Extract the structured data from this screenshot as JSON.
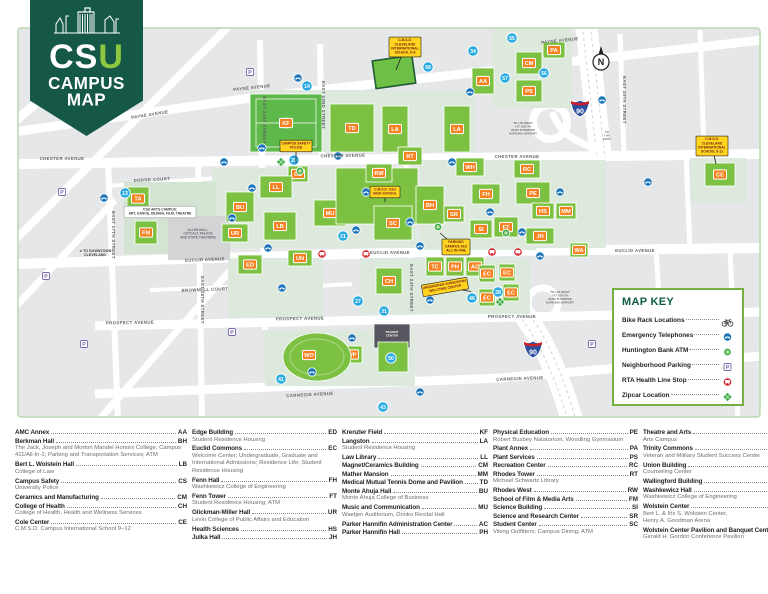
{
  "colors": {
    "pennant_green": "#155847",
    "csu_u_green": "#8dc63f",
    "building_green": "#7cc142",
    "field_green": "#5fb84a",
    "sage": "#dde9dc",
    "block_gray": "#e6e7e8",
    "badge_orange": "#f58220",
    "lot_blue": "#29abe2",
    "phone_blue": "#1a74ba",
    "rta_red": "#d6212b",
    "zip_green": "#3fae49",
    "callout_yellow": "#ffd520",
    "key_border": "#76b043",
    "frame_green": "#bcd9b0"
  },
  "logo": {
    "acronym_cs": "CS",
    "acronym_u": "U",
    "title_line1": "CAMPUS",
    "title_line2": "MAP"
  },
  "map": {
    "street_labels": [
      {
        "t": "PAYNE AVENUE",
        "x": 150,
        "y": 116,
        "r": -9
      },
      {
        "t": "PAYNE AVENUE",
        "x": 252,
        "y": 89,
        "r": -6
      },
      {
        "t": "PAYNE AVENUE",
        "x": 560,
        "y": 42,
        "r": -6
      },
      {
        "t": "CHESTER AVENUE",
        "x": 62,
        "y": 160,
        "r": 0
      },
      {
        "t": "CHESTER AVENUE",
        "x": 343,
        "y": 157,
        "r": -1
      },
      {
        "t": "CHESTER AVENUE",
        "x": 517,
        "y": 158,
        "r": 0
      },
      {
        "t": "EUCLID AVENUE",
        "x": 205,
        "y": 261,
        "r": -2
      },
      {
        "t": "EUCLID AVENUE",
        "x": 390,
        "y": 254,
        "r": 0
      },
      {
        "t": "EUCLID AVENUE",
        "x": 635,
        "y": 252,
        "r": 0
      },
      {
        "t": "PROSPECT AVENUE",
        "x": 130,
        "y": 324,
        "r": -1
      },
      {
        "t": "PROSPECT AVENUE",
        "x": 300,
        "y": 320,
        "r": -1
      },
      {
        "t": "PROSPECT AVENUE",
        "x": 512,
        "y": 318,
        "r": 0
      },
      {
        "t": "CARNEGIE AVENUE",
        "x": 310,
        "y": 396,
        "r": -3
      },
      {
        "t": "CARNEGIE AVENUE",
        "x": 520,
        "y": 380,
        "r": -2
      },
      {
        "t": "EAST 17TH STREET",
        "x": 112,
        "y": 235,
        "r": 90
      },
      {
        "t": "EAST 18TH STREET",
        "x": 201,
        "y": 300,
        "r": 90
      },
      {
        "t": "EAST 21ST STREET",
        "x": 263,
        "y": 120,
        "r": 90
      },
      {
        "t": "EAST 22ND STREET",
        "x": 322,
        "y": 105,
        "r": 90
      },
      {
        "t": "EAST 24TH STREET",
        "x": 410,
        "y": 288,
        "r": 90
      },
      {
        "t": "EAST 30TH STREET",
        "x": 623,
        "y": 100,
        "r": 90
      },
      {
        "t": "DODGE COURT",
        "x": 152,
        "y": 181,
        "r": -3
      },
      {
        "t": "BROWNELL COURT",
        "x": 205,
        "y": 291,
        "r": -2
      }
    ],
    "buildings": [
      {
        "c": "AA",
        "x": 472,
        "y": 68,
        "w": 22,
        "h": 26
      },
      {
        "c": "TD",
        "x": 330,
        "y": 104,
        "w": 44,
        "h": 48
      },
      {
        "c": "LA",
        "x": 382,
        "y": 106,
        "w": 26,
        "h": 46
      },
      {
        "c": "LA",
        "x": 444,
        "y": 106,
        "w": 26,
        "h": 46
      },
      {
        "c": "CS",
        "x": 288,
        "y": 166,
        "w": 20,
        "h": 16
      },
      {
        "c": "LL",
        "x": 260,
        "y": 176,
        "w": 32,
        "h": 22
      },
      {
        "c": "BU",
        "x": 226,
        "y": 192,
        "w": 28,
        "h": 30
      },
      {
        "c": "UR",
        "x": 222,
        "y": 224,
        "w": 26,
        "h": 18
      },
      {
        "c": "LB",
        "x": 264,
        "y": 212,
        "w": 32,
        "h": 28
      },
      {
        "c": "MU",
        "x": 314,
        "y": 200,
        "w": 32,
        "h": 26
      },
      {
        "c": "",
        "x": 336,
        "y": 168,
        "w": 82,
        "h": 56
      },
      {
        "c": "RT",
        "x": 398,
        "y": 147,
        "w": 24,
        "h": 18
      },
      {
        "c": "RW",
        "x": 366,
        "y": 164,
        "w": 26,
        "h": 18
      },
      {
        "c": "SC",
        "x": 374,
        "y": 206,
        "w": 38,
        "h": 34
      },
      {
        "c": "BH",
        "x": 416,
        "y": 186,
        "w": 28,
        "h": 38
      },
      {
        "c": "SR",
        "x": 444,
        "y": 206,
        "w": 20,
        "h": 16
      },
      {
        "c": "SI",
        "x": 470,
        "y": 220,
        "w": 22,
        "h": 18
      },
      {
        "c": "FT",
        "x": 494,
        "y": 217,
        "w": 24,
        "h": 20
      },
      {
        "c": "WH",
        "x": 456,
        "y": 158,
        "w": 28,
        "h": 18
      },
      {
        "c": "FH",
        "x": 472,
        "y": 184,
        "w": 28,
        "h": 20
      },
      {
        "c": "RC",
        "x": 514,
        "y": 160,
        "w": 26,
        "h": 18
      },
      {
        "c": "PE",
        "x": 516,
        "y": 182,
        "w": 34,
        "h": 22
      },
      {
        "c": "HS",
        "x": 532,
        "y": 203,
        "w": 22,
        "h": 16
      },
      {
        "c": "MM",
        "x": 556,
        "y": 203,
        "w": 20,
        "h": 16
      },
      {
        "c": "JH",
        "x": 526,
        "y": 228,
        "w": 28,
        "h": 16
      },
      {
        "c": "TC",
        "x": 426,
        "y": 257,
        "w": 18,
        "h": 19
      },
      {
        "c": "PH",
        "x": 446,
        "y": 257,
        "w": 18,
        "h": 19
      },
      {
        "c": "AC",
        "x": 466,
        "y": 257,
        "w": 18,
        "h": 19
      },
      {
        "c": "EC",
        "x": 479,
        "y": 265,
        "w": 16,
        "h": 17
      },
      {
        "c": "EC",
        "x": 499,
        "y": 264,
        "w": 16,
        "h": 17
      },
      {
        "c": "EC",
        "x": 503,
        "y": 284,
        "w": 16,
        "h": 17
      },
      {
        "c": "EC",
        "x": 479,
        "y": 289,
        "w": 16,
        "h": 17
      },
      {
        "c": "UN",
        "x": 288,
        "y": 250,
        "w": 24,
        "h": 16
      },
      {
        "c": "ED",
        "x": 238,
        "y": 255,
        "w": 24,
        "h": 19
      },
      {
        "c": "CH",
        "x": 376,
        "y": 268,
        "w": 26,
        "h": 26
      },
      {
        "c": "WP",
        "x": 342,
        "y": 346,
        "w": 20,
        "h": 17
      },
      {
        "c": "CM",
        "x": 516,
        "y": 52,
        "w": 26,
        "h": 22
      },
      {
        "c": "PA",
        "x": 543,
        "y": 42,
        "w": 22,
        "h": 16
      },
      {
        "c": "PS",
        "x": 516,
        "y": 80,
        "w": 26,
        "h": 22
      },
      {
        "c": "CE",
        "x": 705,
        "y": 163,
        "w": 30,
        "h": 23
      },
      {
        "c": "TA",
        "x": 127,
        "y": 187,
        "w": 22,
        "h": 23
      },
      {
        "c": "FM",
        "x": 135,
        "y": 221,
        "w": 22,
        "h": 23
      },
      {
        "c": "WA",
        "x": 570,
        "y": 243,
        "w": 18,
        "h": 14
      },
      {
        "c": "",
        "x": 378,
        "y": 342,
        "w": 30,
        "h": 30
      }
    ],
    "field": {
      "c": "KF",
      "x": 250,
      "y": 94,
      "w": 72,
      "h": 58
    },
    "arena": {
      "c": "WO",
      "x": 317,
      "y": 357,
      "rx": 34,
      "ry": 24
    },
    "lots": [
      {
        "n": "13",
        "x": 125,
        "y": 193
      },
      {
        "n": "14",
        "x": 307,
        "y": 86
      },
      {
        "n": "20",
        "x": 294,
        "y": 160
      },
      {
        "n": "21",
        "x": 343,
        "y": 236
      },
      {
        "n": "27",
        "x": 358,
        "y": 301
      },
      {
        "n": "31",
        "x": 384,
        "y": 311
      },
      {
        "n": "34",
        "x": 473,
        "y": 51
      },
      {
        "n": "41",
        "x": 281,
        "y": 379
      },
      {
        "n": "43",
        "x": 383,
        "y": 407
      },
      {
        "n": "50",
        "x": 391,
        "y": 358
      },
      {
        "n": "55",
        "x": 512,
        "y": 38
      },
      {
        "n": "56",
        "x": 544,
        "y": 73
      },
      {
        "n": "57",
        "x": 505,
        "y": 78
      },
      {
        "n": "58",
        "x": 428,
        "y": 67
      },
      {
        "n": "28",
        "x": 498,
        "y": 292
      },
      {
        "n": "46",
        "x": 472,
        "y": 298
      }
    ],
    "phones": [
      [
        298,
        78
      ],
      [
        262,
        148
      ],
      [
        224,
        162
      ],
      [
        252,
        188
      ],
      [
        232,
        218
      ],
      [
        268,
        248
      ],
      [
        282,
        288
      ],
      [
        338,
        156
      ],
      [
        366,
        192
      ],
      [
        410,
        222
      ],
      [
        356,
        230
      ],
      [
        420,
        246
      ],
      [
        452,
        162
      ],
      [
        490,
        212
      ],
      [
        522,
        232
      ],
      [
        560,
        192
      ],
      [
        602,
        100
      ],
      [
        648,
        182
      ],
      [
        430,
        300
      ],
      [
        352,
        338
      ],
      [
        420,
        392
      ],
      [
        540,
        256
      ],
      [
        312,
        372
      ],
      [
        104,
        198
      ],
      [
        470,
        92
      ]
    ],
    "parking_signs": [
      [
        55,
        63
      ],
      [
        42,
        102
      ],
      [
        62,
        192
      ],
      [
        46,
        276
      ],
      [
        84,
        344
      ],
      [
        232,
        332
      ],
      [
        592,
        344
      ],
      [
        664,
        318
      ],
      [
        250,
        72
      ]
    ],
    "rta_stops": [
      [
        322,
        254
      ],
      [
        366,
        254
      ],
      [
        492,
        252
      ],
      [
        518,
        252
      ]
    ],
    "zipcars": [
      [
        281,
        162
      ],
      [
        500,
        302
      ]
    ],
    "atms": [
      [
        300,
        171
      ],
      [
        438,
        227
      ],
      [
        506,
        233
      ]
    ],
    "callouts": [
      {
        "style": "yellow",
        "lines": [
          "C.M.S.D.",
          "CLEVELAND",
          "INTERNATIONAL",
          "SCHOOL K-8"
        ],
        "x": 405,
        "y": 47,
        "r": 0,
        "tail": [
          396,
          70
        ]
      },
      {
        "style": "yellow",
        "lines": [
          "CAMPUS SAFETY",
          "POLICE"
        ],
        "x": 296,
        "y": 146,
        "r": 0,
        "tail": [
          296,
          163
        ]
      },
      {
        "style": "yellow",
        "lines": [
          "C.M.S.D. CSU",
          "HIGH SCHOOL"
        ],
        "x": 385,
        "y": 192,
        "r": 0,
        "tail": [
          385,
          202
        ]
      },
      {
        "style": "yellow",
        "lines": [
          "PARKING",
          "CAMPUS 411/",
          "ALL-IN-ONE"
        ],
        "x": 456,
        "y": 247,
        "r": 0,
        "tail": [
          440,
          233
        ]
      },
      {
        "style": "yellow",
        "lines": [
          "UNDERGRAD ADMISSIONS",
          "WELCOME CENTER"
        ],
        "x": 445,
        "y": 287,
        "r": -10,
        "tail": [
          470,
          296
        ]
      },
      {
        "style": "yellow",
        "lines": [
          "C.M.S.D.",
          "CLEVELAND",
          "INTERNATIONAL",
          "SCHOOL 9-12"
        ],
        "x": 712,
        "y": 146,
        "r": 0,
        "tail": [
          716,
          164
        ]
      },
      {
        "style": "white",
        "lines": [
          "CSU ARTS CAMPUS:",
          "ART, DANCE, DESIGN, FILM, THEATRE"
        ],
        "x": 160,
        "y": 212,
        "r": 0
      }
    ],
    "notes": [
      {
        "t": "ALLEN HALL,\nOUTCALT, PALACE\nAND STATE THEATERS",
        "x": 198,
        "y": 231,
        "s": 3.2,
        "c": "#6d6e71"
      },
      {
        "t": "◄ TO DOWNTOWN\nCLEVELAND",
        "x": 95,
        "y": 252,
        "s": 3.6,
        "c": "#414042"
      },
      {
        "t": "TO I-90 WEST\nI-77 SOUTH\nOHIO TURNPIKE\nHOPKINS AIRPORT",
        "x": 523,
        "y": 124,
        "s": 3.0,
        "c": "#6d6e71"
      },
      {
        "t": "TO\nI-90\nEAST",
        "x": 607,
        "y": 133,
        "s": 3.0,
        "c": "#6d6e71"
      },
      {
        "t": "TO I-90 WEST\nI-77 SOUTH\nOHIO TURNPIKE\nHOPKINS AIRPORT",
        "x": 560,
        "y": 293,
        "s": 3.0,
        "c": "#6d6e71"
      },
      {
        "t": "TRANSIT\nCENTER",
        "x": 392,
        "y": 333,
        "s": 3.0,
        "c": "#ffffff"
      }
    ],
    "shields": [
      {
        "t": "90",
        "x": 580,
        "y": 108
      },
      {
        "t": "90",
        "x": 533,
        "y": 349
      }
    ],
    "compass": {
      "t": "N",
      "x": 601,
      "y": 62
    }
  },
  "map_key": {
    "title": "MAP KEY",
    "items": [
      {
        "label": "Bike Rack Locations",
        "icon": "bike-icon"
      },
      {
        "label": "Emergency Telephones",
        "icon": "phone-icon"
      },
      {
        "label": "Huntington Bank ATM",
        "icon": "atm-icon"
      },
      {
        "label": "Neighborhood Parking",
        "icon": "parking-icon"
      },
      {
        "label": "RTA Health Line Stop",
        "icon": "rta-icon"
      },
      {
        "label": "Zipcar Location",
        "icon": "zipcar-icon"
      }
    ]
  },
  "directory": {
    "columns": [
      [
        {
          "name": "AMC Annex",
          "code": "AA"
        },
        {
          "name": "Berkman Hall",
          "code": "BH",
          "sub": "The Jack, Joseph and Morton Mandel Honors College; Campus 411/All-In-1; Parking and Transportation Services; ATM"
        },
        {
          "name": "Bert L. Wolstein Hall",
          "code": "LB",
          "sub": "College of Law"
        },
        {
          "name": "Campus Safety",
          "code": "CS",
          "sub": "University Police"
        },
        {
          "name": "Ceramics and Manufacturing",
          "code": "CM"
        },
        {
          "name": "College of Health",
          "code": "CH",
          "sub": "College of Health, Health and Wellness Services"
        },
        {
          "name": "Cole Center",
          "code": "CE",
          "sub": "C.M.S.D. Campus International School 9–12"
        }
      ],
      [
        {
          "name": "Edge Building",
          "code": "ED",
          "sub": "Student Residence Housing"
        },
        {
          "name": "Euclid Commons",
          "code": "EC",
          "sub": "Welcome Center; Undergraduate, Graduate and International Admissions; Residence Life; Student Residence Housing"
        },
        {
          "name": "Fenn Hall",
          "code": "FH",
          "sub": "Washkewicz College of Engineering"
        },
        {
          "name": "Fenn Tower",
          "code": "FT",
          "sub": "Student Residence Housing; ATM"
        },
        {
          "name": "Glickman-Miller Hall",
          "code": "UR",
          "sub": "Levin College of Public Affairs and Education"
        },
        {
          "name": "Health Sciences",
          "code": "HS"
        },
        {
          "name": "Julka Hall",
          "code": "JH"
        }
      ],
      [
        {
          "name": "Krenzler Field",
          "code": "KF"
        },
        {
          "name": "Langston",
          "code": "LA",
          "sub": "Student Residence Housing"
        },
        {
          "name": "Law Library",
          "code": "LL"
        },
        {
          "name": "Magnet/Ceramics Building",
          "code": "CM"
        },
        {
          "name": "Mather Mansion",
          "code": "MM"
        },
        {
          "name": "Medical Mutual Tennis Dome and Pavilion",
          "code": "TD"
        },
        {
          "name": "Monte Ahuja Hall",
          "code": "BU",
          "sub": "Monte Ahuja College of Business"
        },
        {
          "name": "Music and Communication",
          "code": "MU",
          "sub": "Waetjen Auditorium, Drinko Recital Hall"
        },
        {
          "name": "Parker Hannifin Administration Center",
          "code": "AC"
        },
        {
          "name": "Parker Hannifin Hall",
          "code": "PH"
        }
      ],
      [
        {
          "name": "Physical Education",
          "code": "PE",
          "sub": "Robert Busbey Natatorium, Woodling Gymnasium"
        },
        {
          "name": "Plant Annex",
          "code": "PA"
        },
        {
          "name": "Plant Services",
          "code": "PS"
        },
        {
          "name": "Recreation Center",
          "code": "RC"
        },
        {
          "name": "Rhodes Tower",
          "code": "RT",
          "sub": "Michael Schwartz Library"
        },
        {
          "name": "Rhodes West",
          "code": "RW"
        },
        {
          "name": "School of Film & Media Arts",
          "code": "FM"
        },
        {
          "name": "Science Building",
          "code": "SI"
        },
        {
          "name": "Science and Research Center",
          "code": "SR"
        },
        {
          "name": "Student Center",
          "code": "SC",
          "sub": "Viking Outfitters; Campus Dining; ATM"
        }
      ],
      [
        {
          "name": "Theatre and Arts",
          "code": "TA",
          "sub": "Arts Campus"
        },
        {
          "name": "Trinity Commons",
          "code": "TC",
          "sub": "Veteran and Military Student Success Center"
        },
        {
          "name": "Union Building",
          "code": "UN",
          "sub": "Counseling Center"
        },
        {
          "name": "Wallingford Building",
          "code": "WA"
        },
        {
          "name": "Washkewicz Hall",
          "code": "WH",
          "sub": "Washkewicz College of Engineering"
        },
        {
          "name": "Wolstein Center",
          "code": "WO",
          "sub": "Bert L. & Iris S. Wolstein Center,\nHenry A. Goodman Arena"
        },
        {
          "name": "Wolstein Center Pavilion and Banquet Center",
          "code": "WP",
          "sub": "Gerald H. Gordon Conference Pavilion"
        }
      ]
    ]
  }
}
